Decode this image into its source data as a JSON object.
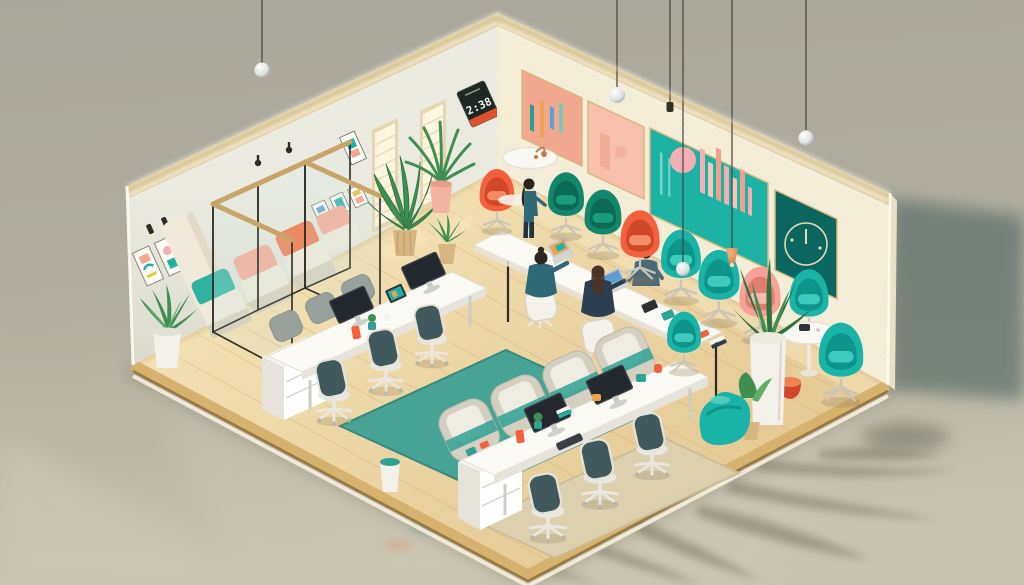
{
  "scene": {
    "alt": "Isometric 3D illustration of a colorful coworking office: glass meeting booths with teal and coral cushions, white desks with monitors and task chairs, a row of emerald, turquoise and coral egg chairs along an art-lined wall, plants, pendant lights, teal rug, on a glossy olive studio backdrop."
  },
  "wall_clock": {
    "time": "2:38"
  },
  "palette": {
    "bg_top": "#a9a79b",
    "bg_mid": "#b1ae9f",
    "bg_bottom": "#c8c3b1",
    "shadow_wedge": "#5d6f6a",
    "backdrop_shadow": "#6f6a58",
    "floor_wood": "#e6cb97",
    "floor_light": "#f3e2b5",
    "floor_edge": "#d6b26e",
    "floor_edge_dark": "#8d6931",
    "floor_rim_light": "#f6efdc",
    "plank": "#d3b47e",
    "left_wall": "#eaeae0",
    "right_wall": "#f4eed9",
    "wall_glow": "#fffdf2",
    "wall_trim": "#d9c491",
    "wall_texture": "#e7ddc0",
    "rug_teal": "#47a495",
    "rug_teal_dark": "#388a7d",
    "rug_beige": "#ddd1b0",
    "bench_cream": "#f0e9d9",
    "bench_shadow": "#d8cfba",
    "cushion_teal": "#2fb3a0",
    "cushion_salmon": "#f6a791",
    "cushion_orange": "#f07a4b",
    "emerald": "#12876b",
    "emerald_dark": "#0c6a54",
    "turquoise": "#19b4a7",
    "turquoise_dark": "#0e948a",
    "coral": "#f2603c",
    "coral_dark": "#d04828",
    "salmon": "#f6a296",
    "salmon_dark": "#e07f6e",
    "desk_white": "#fbfaf5",
    "desk_side": "#e6e3da",
    "cabinet_white": "#f6f4ee",
    "monitor_dark": "#23282e",
    "monitor_edge": "#3c4248",
    "chair_mesh": "#40595c",
    "chair_frame": "#e9e7df",
    "chair_gray": "#98a19c",
    "glass_frame": "#2e2c27",
    "wood_rail": "#c9a468",
    "window_light": "#fff6df",
    "window_frame": "#e6d6ae",
    "clock_bg": "#1d2822",
    "clock_text": "#f4f4ee",
    "clock_band": "#e0502c",
    "art_salmon": "#f2a78f",
    "art_salmon_light": "#f8c0ab",
    "art_teal": "#1cb3a5",
    "art_dark_teal": "#0c6660",
    "art_pink": "#f4aeb6",
    "art_gold": "#d8b87c",
    "plant_green": "#3e8f50",
    "plant_green_dark": "#2d7240",
    "plant_green_light": "#5fae67",
    "pot_white": "#f3f1ea",
    "pot_tan": "#d7b684",
    "pot_pink": "#f3b3a1",
    "pendant_copper": "#cd7f4c",
    "skin": "#c9906f",
    "hair": "#2c2420",
    "outfit_teal": "#2f6976",
    "outfit_navy": "#2c3f52",
    "outfit_slate": "#4a6a78",
    "metal_copper": "#c87a45",
    "bin_teal": "#2fa193"
  }
}
